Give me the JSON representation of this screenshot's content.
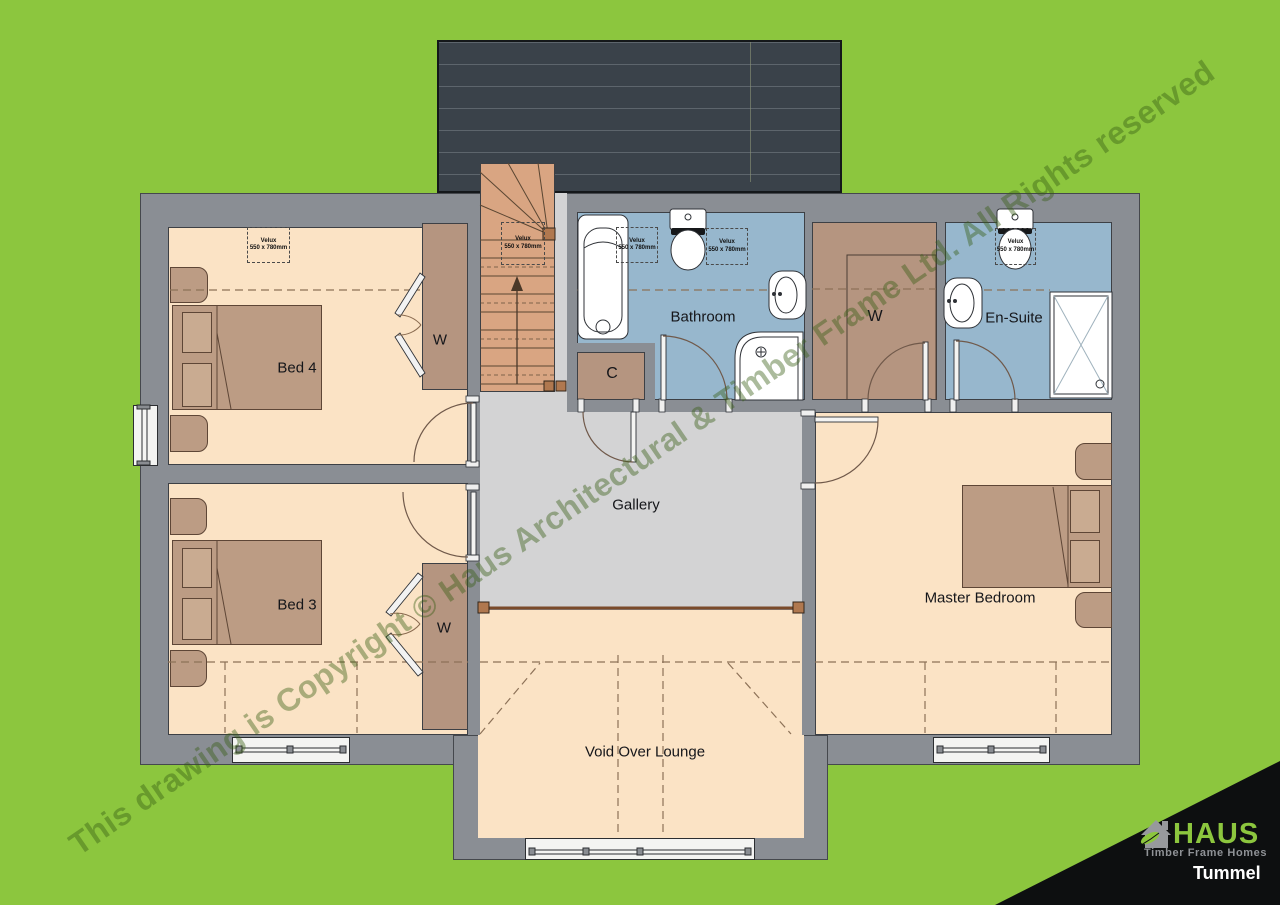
{
  "document": {
    "type": "first-floor-plan-drawing",
    "watermark": "This drawing is Copyright © Haus Architectural & Timber Frame Ltd. All Rights reserved"
  },
  "brand": {
    "name": "HAUS",
    "tagline": "Timber Frame Homes",
    "plan_name": "Tummel"
  },
  "rooms": {
    "bed4": {
      "label": "Bed 4"
    },
    "bed3": {
      "label": "Bed 3"
    },
    "bathroom": {
      "label": "Bathroom"
    },
    "ensuite": {
      "label": "En-Suite"
    },
    "wardrobe": {
      "label": "W"
    },
    "cupboard": {
      "label": "C"
    },
    "gallery": {
      "label": "Gallery"
    },
    "master": {
      "label": "Master Bedroom"
    },
    "void_lounge": {
      "label": "Void Over Lounge"
    }
  },
  "annotations": {
    "velux": {
      "line1": "Velux",
      "line2": "550 x 780mm"
    }
  },
  "colors": {
    "site_green": "#8CC63E",
    "wall_grey": "#8A8E94",
    "floor_cream": "#FBE3C5",
    "wet_room_blue": "#97B7CD",
    "furniture_brown": "#B59580",
    "bed_brown": "#BC9C84",
    "stairs_tan": "#D9A582",
    "landing_grey": "#D3D3D4",
    "roof_slate": "#3A424A",
    "banner_black": "#0d0f10",
    "logo_grey": "#97999D"
  }
}
